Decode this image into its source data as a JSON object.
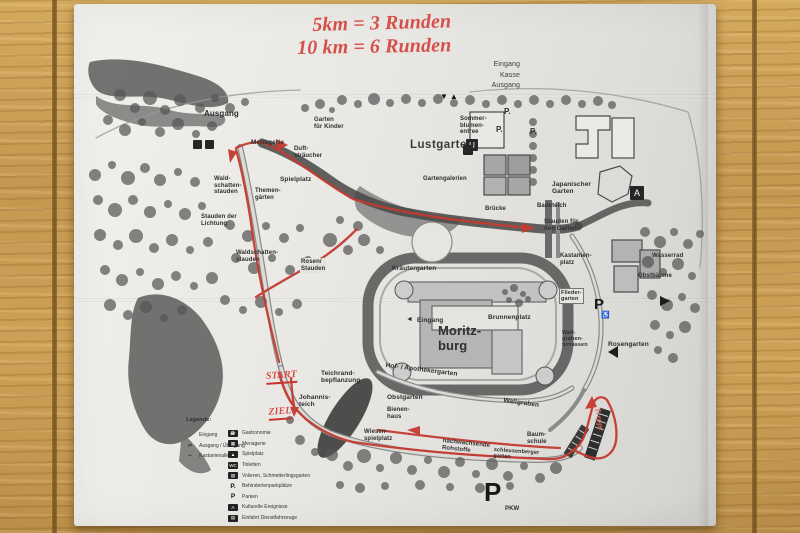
{
  "annotations": {
    "title_line1": "5km = 3 Runden",
    "title_line2": "10 km = 6 Runden",
    "start": "START",
    "ziel": "ZIEL",
    "stairs_note": "Treppe"
  },
  "map": {
    "entrance_block": "Eingang\nKasse\nAusgang",
    "gate_triangles": "▼▲",
    "labels": {
      "ausgang": "Ausgang",
      "menagerie": "Menagerie",
      "duftstraeucher": "Duft-\nsträucher",
      "spielplatz": "Spielplatz",
      "themengaerten": "Themen-\ngärten",
      "garten_fuer_kinder": "Garten\nfür Kinder",
      "lustgarten": "Lustgarten",
      "gartengalerien": "Gartengalerien",
      "sommerblumen_entree": "Sommer-\nblumen-\nentree",
      "p_dot_1": "P.",
      "p_dot_2": "P.",
      "p_dot_3": "P.",
      "japanischer_garten": "Japanischer\nGarten",
      "wasserrad": "Wasserrad",
      "badeteich": "Badeteich",
      "bruecke": "Brücke",
      "stauden_fuer_den_garten": "Stauden für\nden Garten",
      "wald_schatten_stauden": "Wald-\nschatten-\nstauden",
      "stauden_der_lichtung": "Stauden der\nLichtung",
      "waldschattenstauden": "Waldschatten-\nstauden",
      "rosen_stauden": "Rosen/\nStauden",
      "kraeutergarten": "Kräutergarten",
      "eingang_schloss": "Eingang",
      "eingang_arrow": "◄",
      "moritzburg": "Moritz-\nburg",
      "brunnenplatz": "Brunnenplatz",
      "kastanienplatz": "Kastanien-\nplatz",
      "fliedergarten": "Flieder-\ngarten",
      "wallgraben_terrassen": "Wall-\ngraben-\nterrassen",
      "rosengarten": "Rosengarten",
      "obstbaeume": "Obstbäume",
      "hof_apothekergarten": "Hof- / Apothekergarten",
      "obstgarten": "Obstgarten",
      "bienenhaus": "Bienen-\nhaus",
      "wallgraben": "Wallgraben",
      "wiesenspielplatz": "Wiesen-\nspielplatz",
      "nachwachsende_rohstoffe": "nachwachsende\nRohstoffe",
      "baumschule": "Baum-\nschule",
      "schleusenberger_garten": "schleusenberger\ngarten",
      "johannisteich": "Johannis-\nteich",
      "teichrand_bepflanzung": "Teichrand-\nbepflanzung"
    },
    "icons": {
      "info_box": "U",
      "a_box": "A",
      "parking_accessible": "P",
      "wheelchair": "♿",
      "parking_big": "P",
      "pkw": "PKW"
    },
    "legend": {
      "title": "Legende:",
      "left": [
        {
          "symbol": "→",
          "label": "Eingang"
        },
        {
          "symbol": "⇄",
          "label": "Ausgang / Übergang"
        },
        {
          "symbol": "━",
          "label": "Kastanienallee"
        }
      ],
      "right": [
        {
          "icon": "☕",
          "label": "Gastronomie"
        },
        {
          "icon": "▦",
          "label": "Menagerie"
        },
        {
          "icon": "▲",
          "label": "Spielplatz"
        },
        {
          "icon": "WC",
          "label": "Toiletten"
        },
        {
          "icon": "▧",
          "label": "Volieren, Schmetterlingsgarten"
        },
        {
          "icon": "P.",
          "label": "Behindertenparkplätze"
        },
        {
          "icon": "P",
          "label": "Parken"
        },
        {
          "icon": "A",
          "label": "Kulturelle Ereignisse"
        },
        {
          "icon": "▤",
          "label": "Einfahrt Dienstfahrzeuge"
        }
      ]
    },
    "colors": {
      "route_red": "#c43a30",
      "handwriting_red": "#d65049"
    }
  }
}
